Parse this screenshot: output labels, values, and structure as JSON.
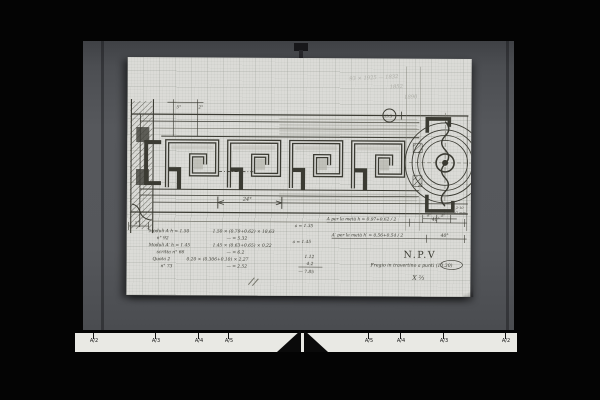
{
  "ruler": {
    "labels": [
      "A/2",
      "A/3",
      "A/4",
      "A/5",
      "A/5",
      "A/4",
      "A/3",
      "A/2"
    ]
  },
  "drawing": {
    "detail_marker": "13.5",
    "scribbles": [
      "93 × 1925 — 1832",
      "1852",
      "1890"
    ],
    "dims": {
      "d24": "24°",
      "d40a": "40°",
      "d40b": "40°",
      "d5": "5°",
      "d2": "2°",
      "left5": "5°",
      "c4a": "4°",
      "c4b": "4°"
    },
    "notes": {
      "a_top": "A  per la metà h =  0.97+0.62 / 2",
      "a_bottom": "A′ per la metà h′ =  0.56+0.54 / 2",
      "a_eq_top": "a = 1.35",
      "a_eq_bottom": "a = 1.45",
      "circle_note1": "5,2·10",
      "circle_note2": "5/2 mm"
    },
    "calc": {
      "rows": [
        {
          "l": "Moduli A  h = 1.50",
          "r": "1.50 × (0.79+0.62) × 18,63"
        },
        {
          "l": "n° 92",
          "r": "— = 5.32"
        },
        {
          "l": "Moduli A′ h = 1.45",
          "r": "1.45 × (0.63+0.65) × 0,22"
        },
        {
          "l": "scritta n° 66",
          "r": "— = 6.2"
        },
        {
          "l": "Quota 2",
          "r": "0.20 × (0.306+0.10) × 2,27"
        },
        {
          "l": "n° 73",
          "r": "— = 2.52"
        }
      ],
      "sums": [
        "1.12",
        "4.2",
        "— 7.85"
      ]
    },
    "title": "N.P.V",
    "subtitle": "Fregio in travertino a punti (13.30)",
    "sig": "X ⅔"
  }
}
